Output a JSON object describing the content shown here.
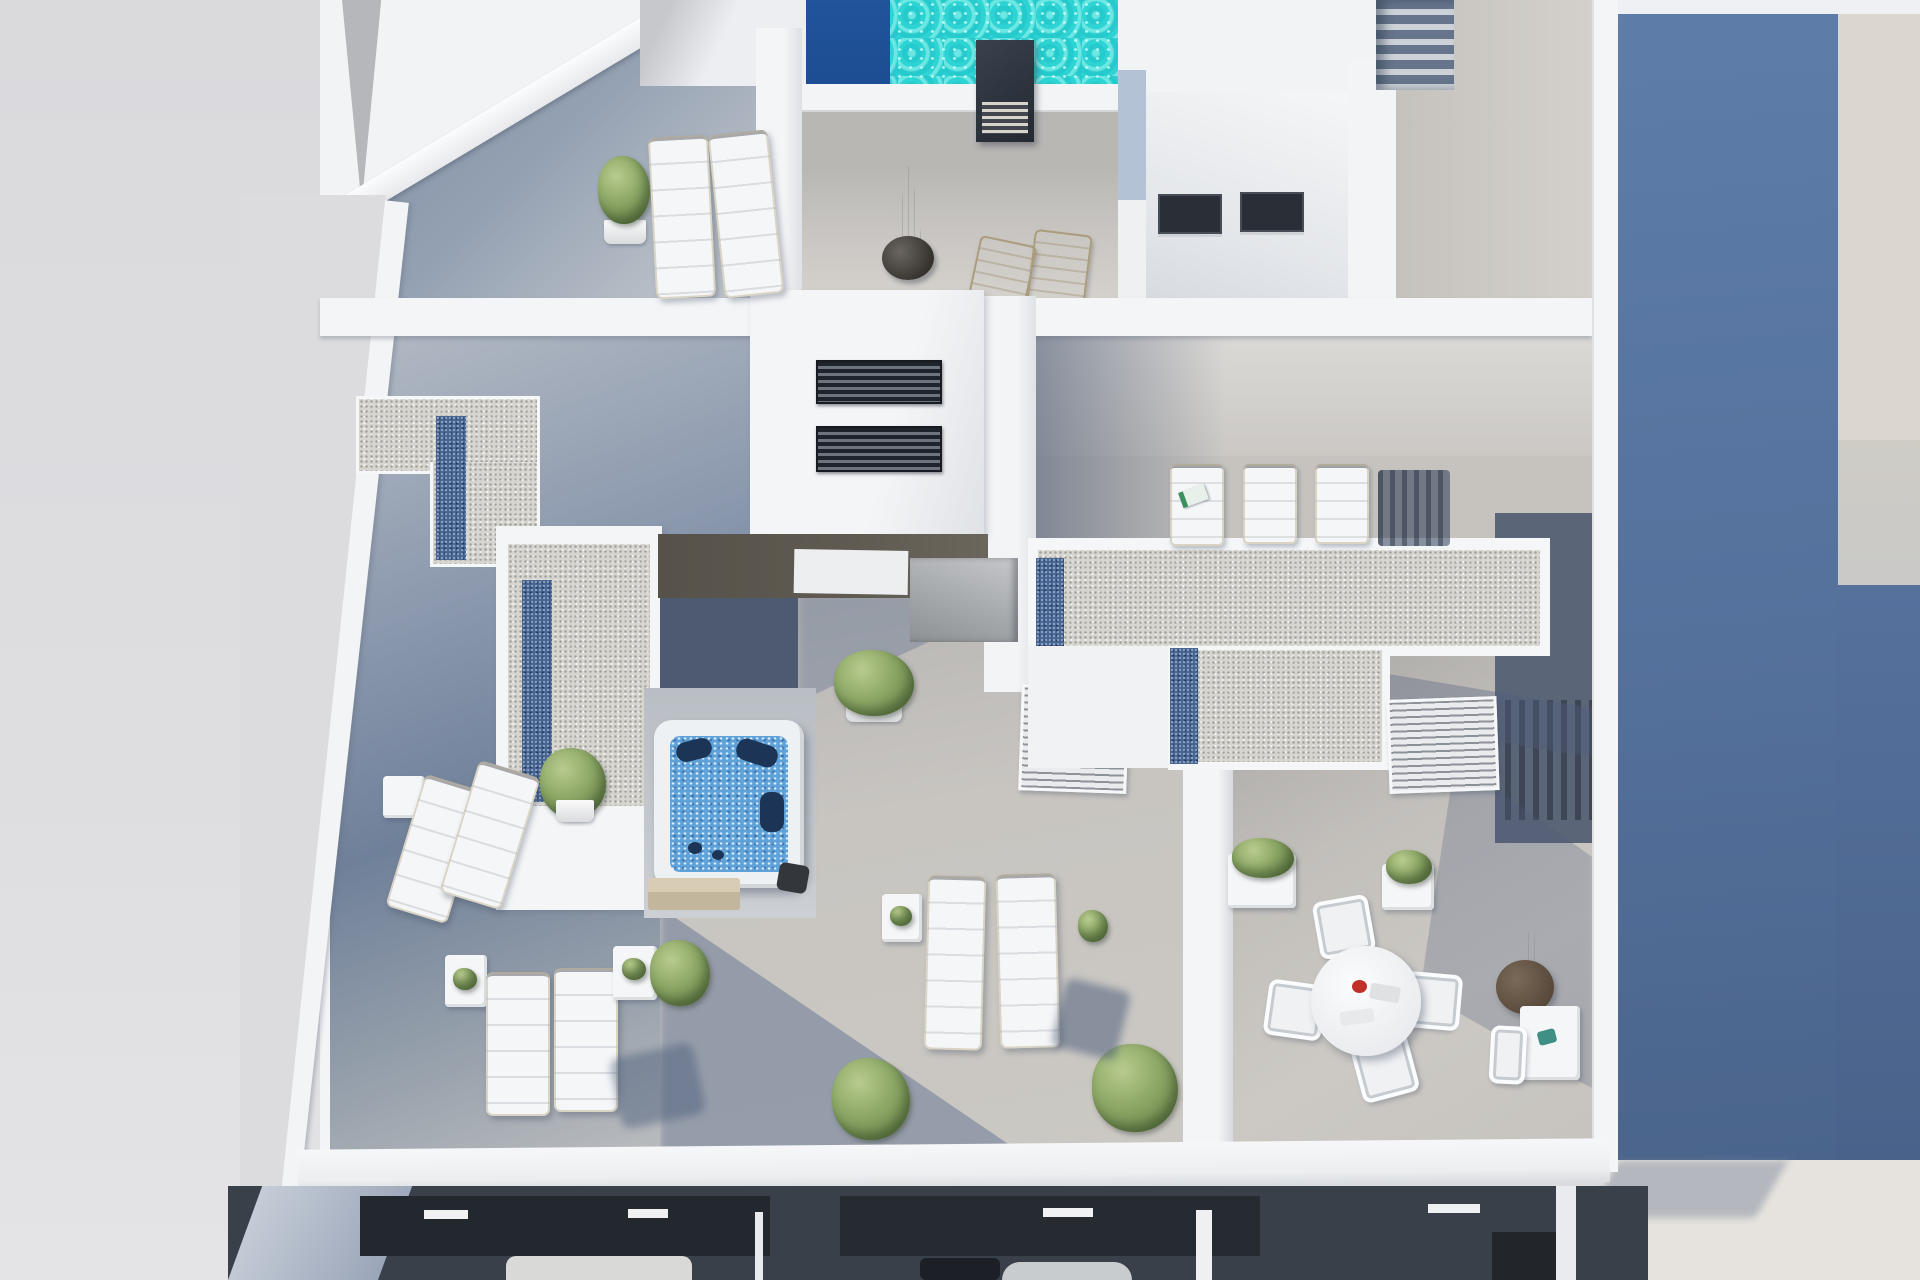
{
  "scene": {
    "type": "architectural-3d-render",
    "subject": "Aerial top-down photorealistic render of a rooftop solarium level of a modern white apartment building",
    "view": "top-down",
    "rooms_visible": "rooftop terraces plus a sliver of the open floor below at the bottom edge"
  },
  "palette": {
    "bg_left": "#dcdcdf",
    "white_wall": "#f2f4f6",
    "deck_light": "#cbc8c3",
    "deck_shadow": "#7d8ba1",
    "gravel": "#d7d5d0",
    "glass_blue": "#46618c",
    "pool_turquoise": "#2ed3d4",
    "pool_deep": "#1d4d92",
    "jacuzzi_water": "#5fa2d9",
    "jacuzzi_seat": "#1c3456",
    "chimney_dark": "#242932",
    "right_blue_top": "#5e7da9",
    "right_blue_bottom": "#4a648b",
    "right_beige": "#dbd7d0",
    "interior_dark": "#3a4049",
    "interior_deep": "#23272e",
    "plant_green_light": "#b8cb8e",
    "plant_green_dark": "#5f7a40",
    "furniture_white": "#f5f6f8",
    "umbrella_brown": "#57483a",
    "shadow_tint": "rgba(85,105,140,0.45)"
  },
  "objects": {
    "swimming_pool": {
      "label": "infinity pool, turquoise shallow zone and dark-blue deep lane",
      "position": "top center"
    },
    "chimney": {
      "label": "dark ventilation chimney with louvre grille",
      "position": "top center on pool coping"
    },
    "courtyard_volume": {
      "label": "white stair volume with interior lightwell and four dark windows",
      "position": "top right"
    },
    "stairs": {
      "label": "exterior staircase",
      "position": "top right corner"
    },
    "hot_tub": {
      "label": "square white jacuzzi with blue bubbling water and navy seats",
      "position": "center left"
    },
    "skylight_strips": {
      "label": "4 blue glass skylight bands set into gravel roof decks",
      "count": 4
    },
    "gravel_roofs": {
      "label": "white-framed gravel roof decks (L-shape left, T-shape right)",
      "count": 3
    },
    "stair_bulkhead": {
      "label": "white bulkhead with two dark slatted skylights",
      "position": "center"
    },
    "sun_loungers_white": {
      "count": 9
    },
    "deck_chairs_wood": {
      "count": 2
    },
    "umbrellas_closed": {
      "count": 2
    },
    "dining_set": {
      "label": "round white table with 4 white chairs and red flower centrepiece",
      "position": "lower right terrace"
    },
    "side_tables": {
      "count": 5
    },
    "potted_plants": {
      "count": 10
    },
    "louvered_closets": {
      "count": 2
    },
    "lower_floor": {
      "label": "shadowed interior of floor below with kitchen runs, sofa and round table",
      "position": "bottom edge"
    },
    "neighbour_wall": {
      "label": "tall blue-grey shaded building wall",
      "position": "right edge"
    }
  }
}
